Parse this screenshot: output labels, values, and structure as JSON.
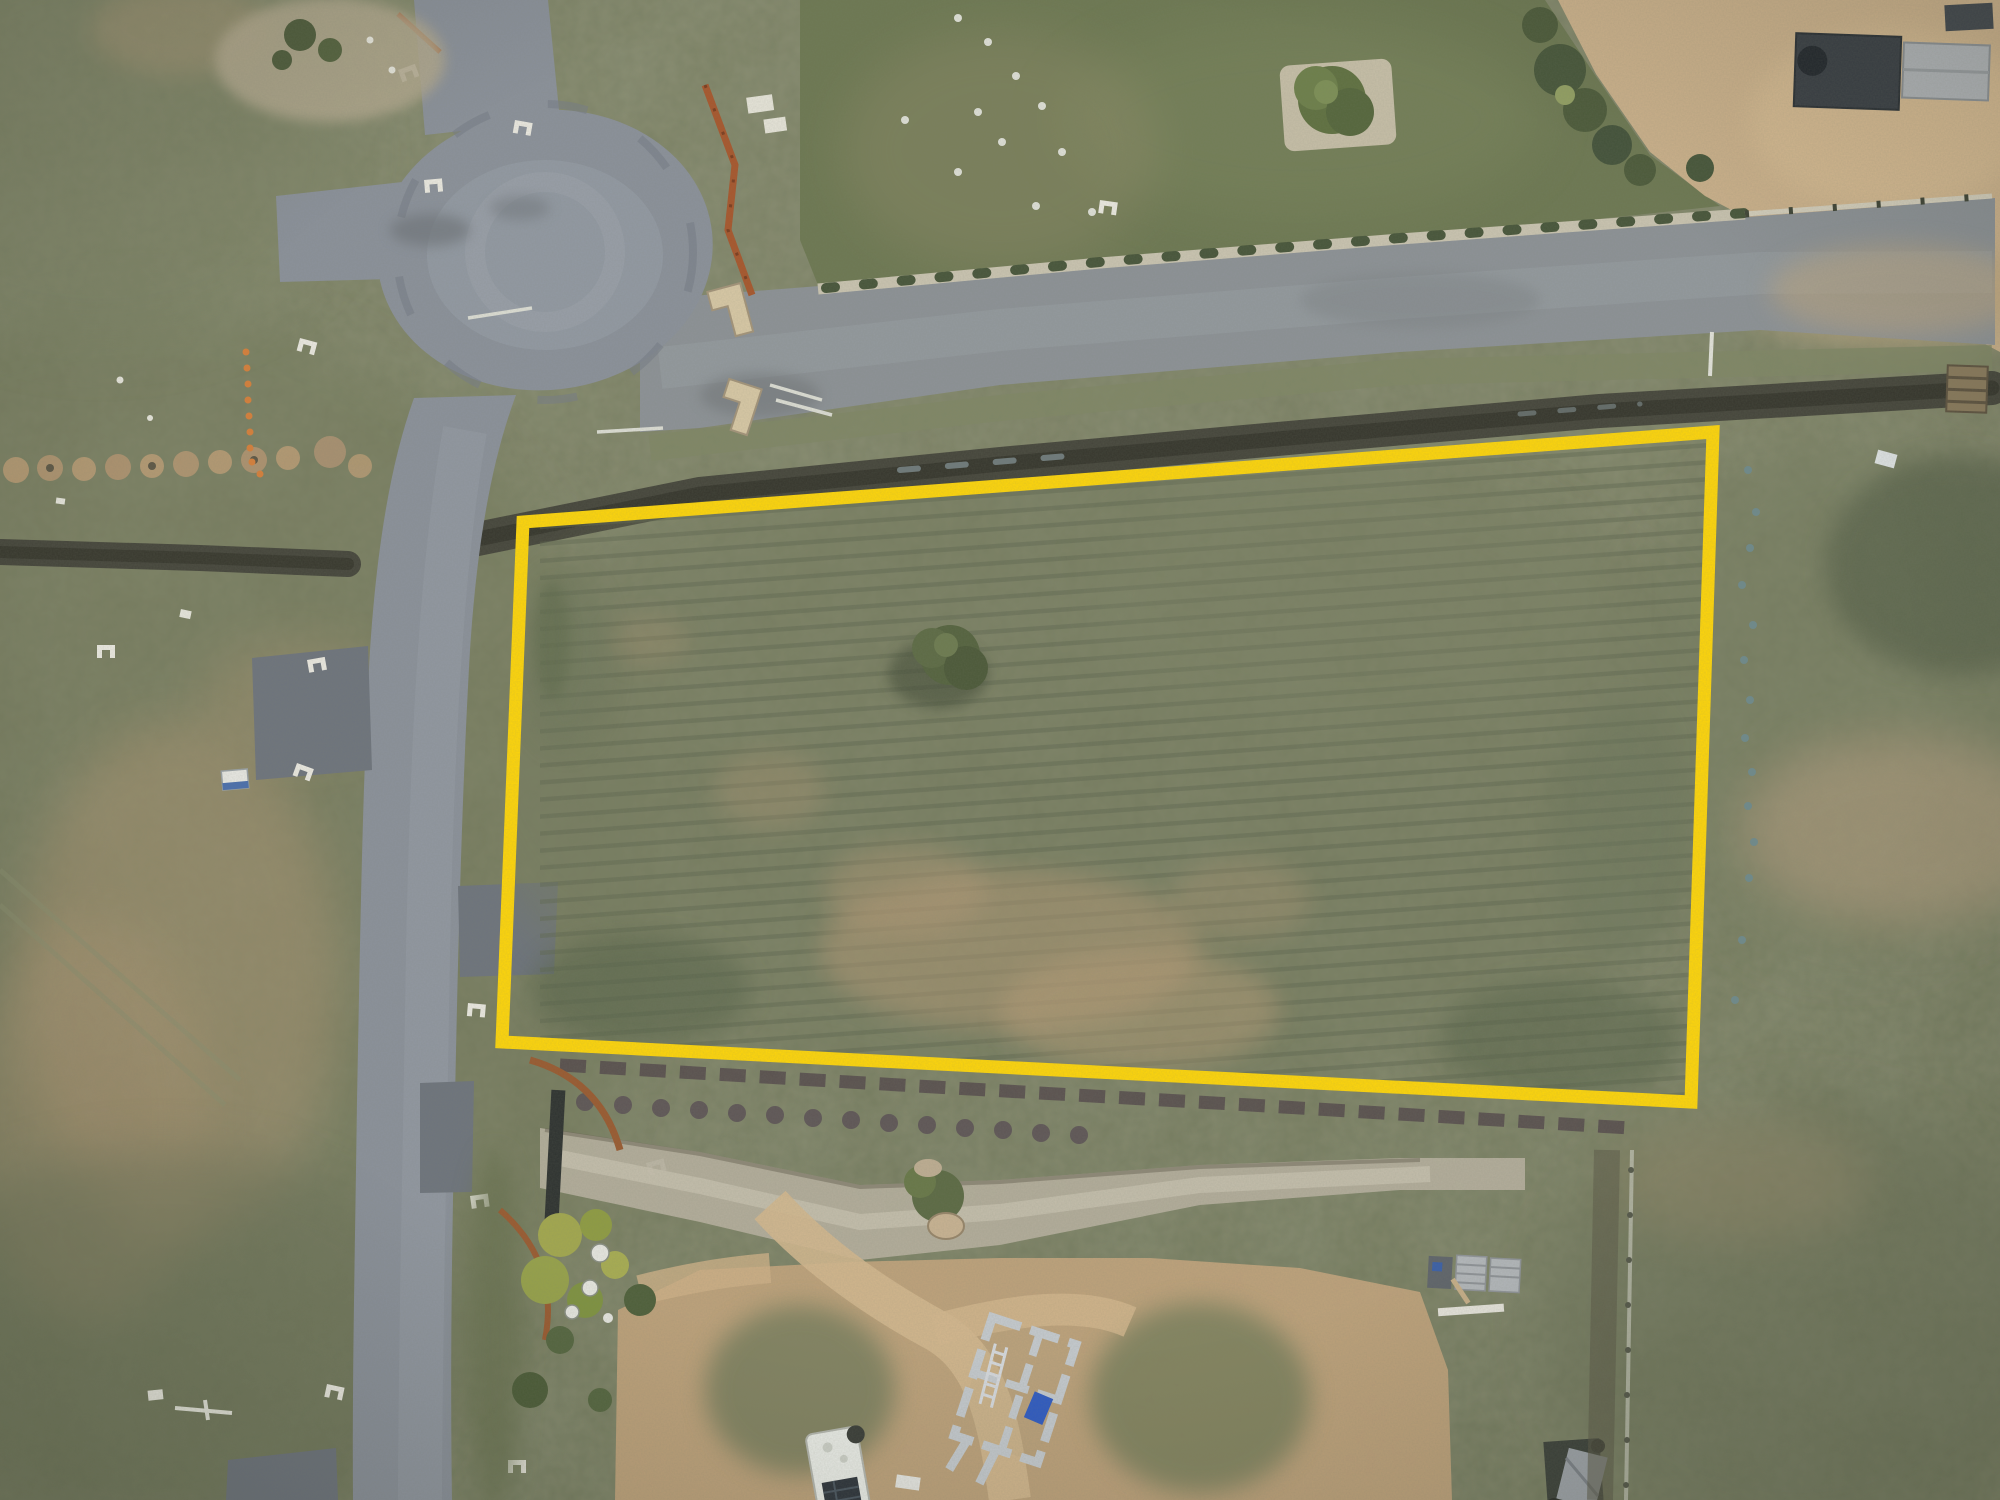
{
  "meta": {
    "image_type": "aerial drone photograph, top-down (nadir) view",
    "subject": "vacant rural residential land parcel outlined with a yellow boundary marker",
    "no_text_in_image": true
  },
  "palette": {
    "boundary": "#ffd60a",
    "grass_base": "#787e61",
    "grass_dark": "#5d684e",
    "grass_light": "#8a8f70",
    "tan": "#b59a76",
    "tan_light": "#cdb28c",
    "road": "#8b919b",
    "road_light": "#9ba3ad",
    "road_dark": "#6e747d",
    "gravel": "#8d9297",
    "ditch": "#45453b",
    "path": "#cbc5b2",
    "lawn": "#6d7852",
    "dirt": "#cdb28c",
    "concrete": "#c6cbd0",
    "rust": "#a8562c",
    "beige": "#d9c9a6"
  },
  "lot": {
    "boundary_points": "523,522 1713,432 1691,1102 502,1042",
    "boundary_stroke_width": "13",
    "description": "large rectangular grass paddock highlighted for sale"
  },
  "features": [
    {
      "name": "culdesac",
      "description": "asphalt cul-de-sac turning circle, top left"
    },
    {
      "name": "main-road",
      "description": "asphalt road running south along the left side"
    },
    {
      "name": "gravel-road",
      "description": "grey gravel road running diagonally across the top"
    },
    {
      "name": "footpath",
      "description": "light footpath with a row of young street plantings"
    },
    {
      "name": "drainage-ditch",
      "description": "dark wet drainage channel above the lot boundary"
    },
    {
      "name": "lot-tree",
      "description": "single small tree inside the parcel"
    },
    {
      "name": "lawn",
      "description": "mown green lawn of neighbouring property, top right"
    },
    {
      "name": "sheds",
      "description": "two sheds on dirt yard, top right corner"
    },
    {
      "name": "construction-fence",
      "description": "orange temporary fencing beside the cul-de-sac"
    },
    {
      "name": "creek-bed",
      "description": "gravel drainage swale crossing below the lot"
    },
    {
      "name": "house-foundation",
      "description": "concrete strip footings under construction, bottom centre"
    },
    {
      "name": "caravan",
      "description": "white caravan with solar panel, bottom centre-left"
    },
    {
      "name": "pallets",
      "description": "stacked building material pallets on dirt, bottom right"
    },
    {
      "name": "garden-beds",
      "description": "landscaped shrubs with rusted steel edging, bottom left"
    }
  ]
}
